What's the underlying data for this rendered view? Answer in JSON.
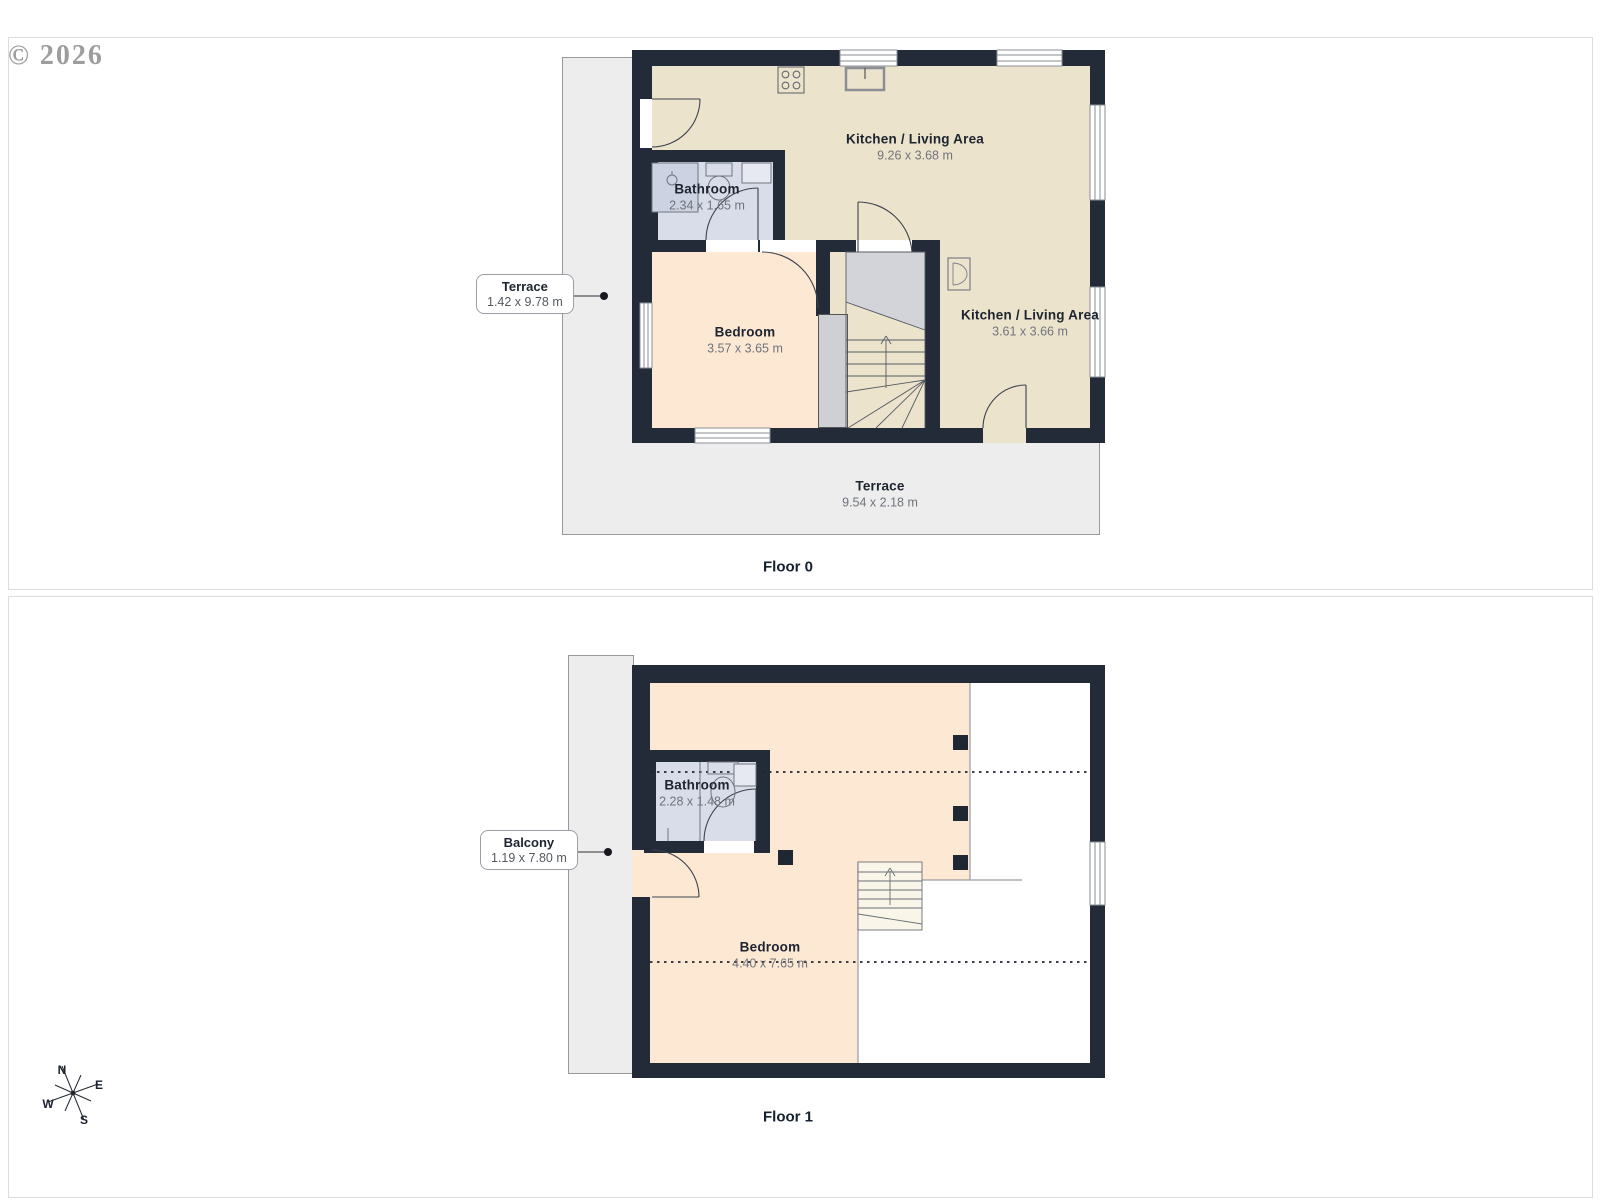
{
  "watermark": "© 2026",
  "floor0": {
    "label": "Floor 0",
    "rooms": {
      "kitchen_main": {
        "name": "Kitchen / Living Area",
        "dims": "9.26 x 3.68 m"
      },
      "bathroom": {
        "name": "Bathroom",
        "dims": "2.34 x 1.65 m"
      },
      "bedroom": {
        "name": "Bedroom",
        "dims": "3.57 x 3.65 m"
      },
      "kitchen_side": {
        "name": "Kitchen / Living Area",
        "dims": "3.61 x 3.66 m"
      },
      "terrace_bottom": {
        "name": "Terrace",
        "dims": "9.54 x 2.18 m"
      }
    },
    "callout": {
      "name": "Terrace",
      "dims": "1.42 x 9.78 m"
    }
  },
  "floor1": {
    "label": "Floor 1",
    "rooms": {
      "bathroom": {
        "name": "Bathroom",
        "dims": "2.28 x 1.48 m"
      },
      "bedroom": {
        "name": "Bedroom",
        "dims": "4.40 x 7.65 m"
      }
    },
    "callout": {
      "name": "Balcony",
      "dims": "1.19 x 7.80 m"
    }
  },
  "compass": {
    "n": "N",
    "e": "E",
    "w": "W",
    "s": "S"
  },
  "colors": {
    "wall": "#232b38",
    "kitchen": "#ece3cd",
    "bedroom": "#fce8d3",
    "bathroom": "#d9dde9",
    "terrace": "#ededee"
  }
}
